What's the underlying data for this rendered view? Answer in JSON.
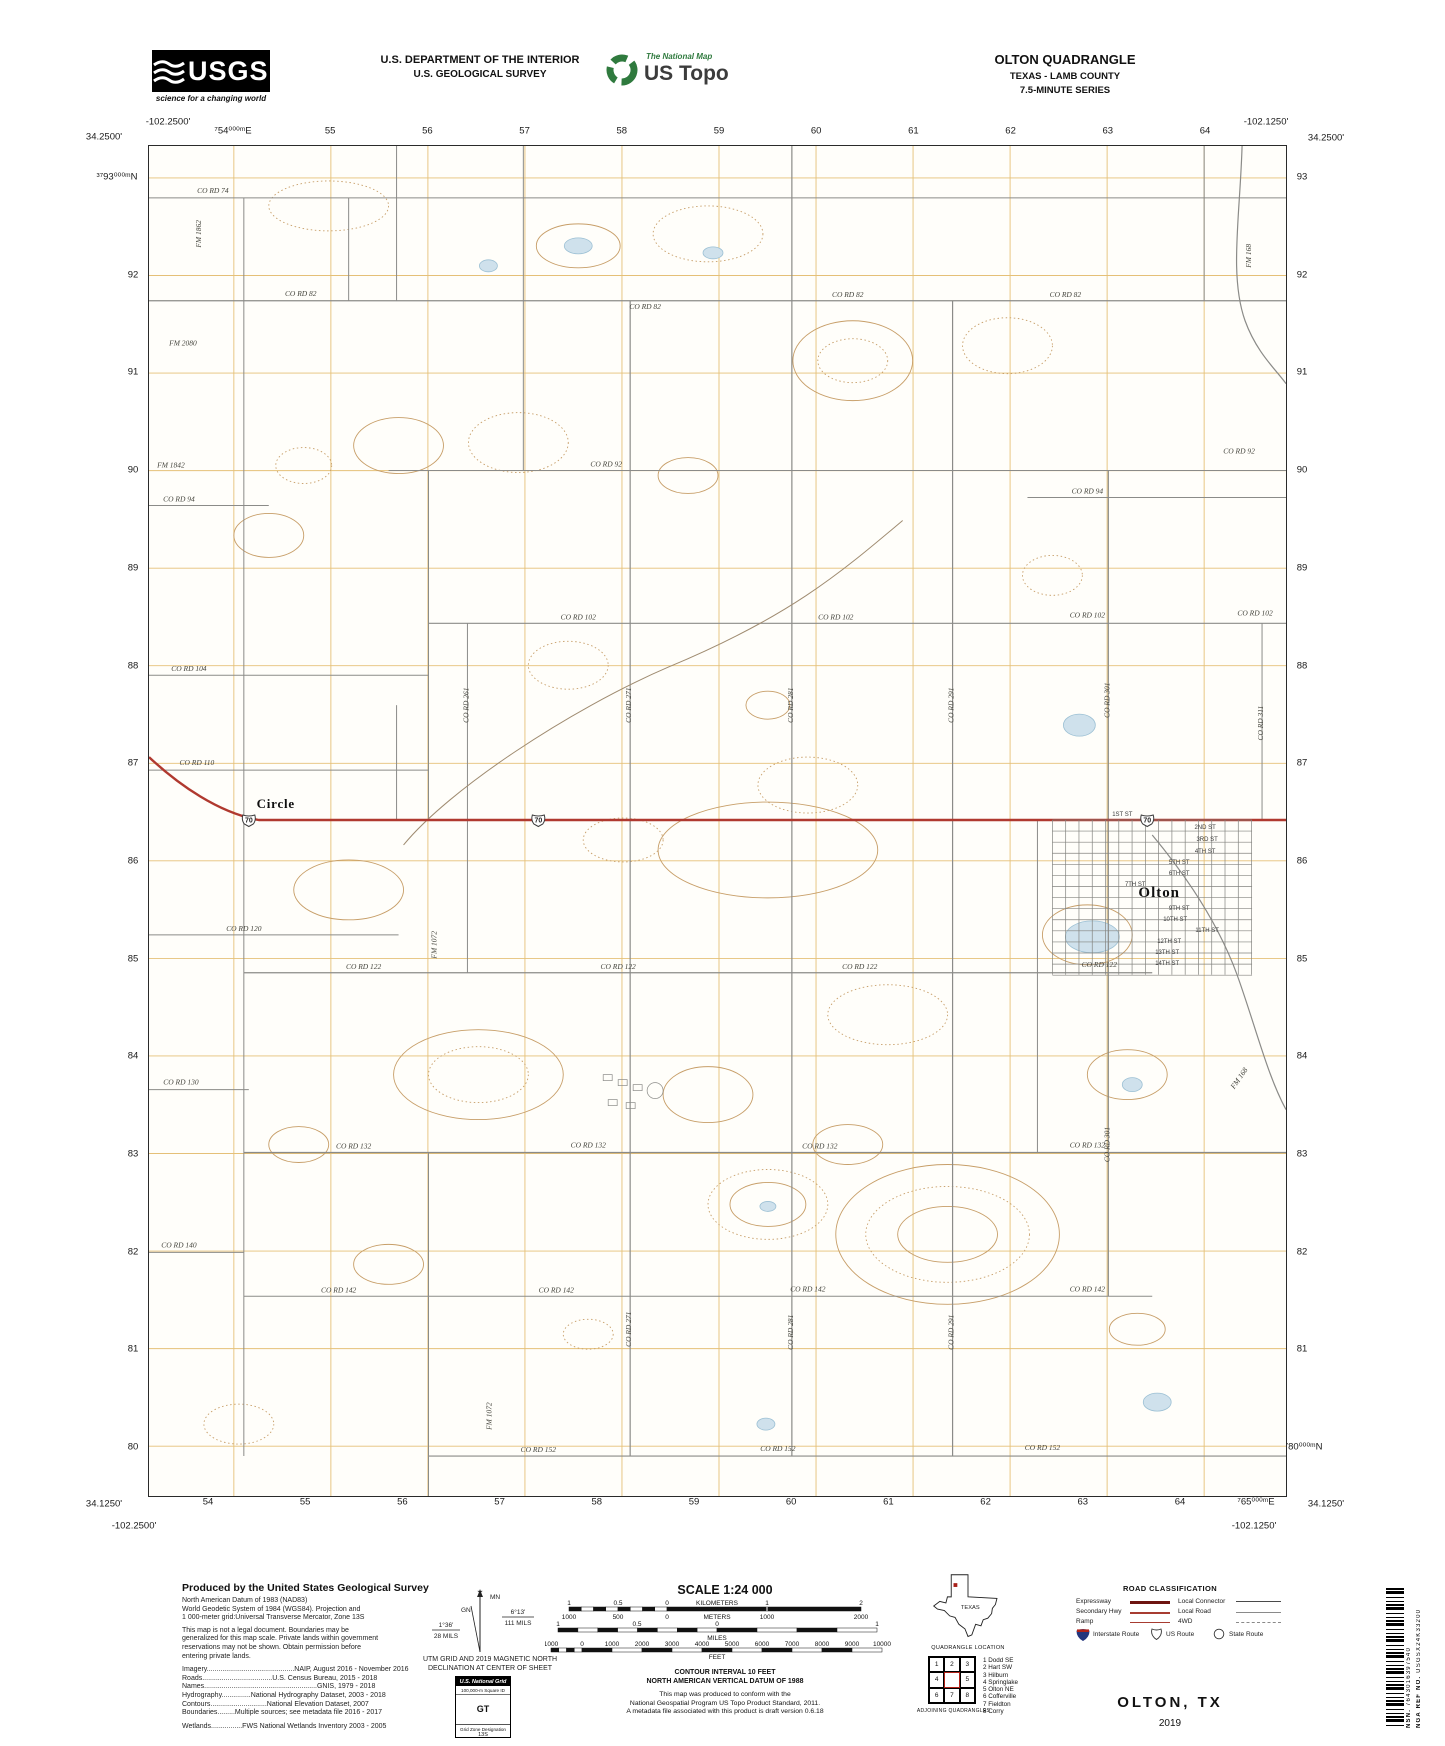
{
  "header": {
    "usgs_acronym": "USGS",
    "usgs_tagline": "science for a changing world",
    "dept_line1": "U.S. DEPARTMENT OF THE INTERIOR",
    "dept_line2": "U.S. GEOLOGICAL SURVEY",
    "brand_top": "The National Map",
    "brand_name": "US Topo",
    "quad_title": "OLTON QUADRANGLE",
    "quad_region": "TEXAS - LAMB COUNTY",
    "quad_series": "7.5-MINUTE SERIES"
  },
  "map": {
    "corners": {
      "tl_lon": "-102.2500'",
      "tl_lat": "34.2500'",
      "tr_lon": "-102.1250'",
      "tr_lat": "34.2500'",
      "bl_lat": "34.1250'",
      "bl_lon": "-102.2500'",
      "br_lon": "-102.1250'",
      "br_lat": "34.1250'"
    },
    "grid": {
      "top_full": "⁷54⁰⁰⁰ᵐE",
      "top": [
        "55",
        "56",
        "57",
        "58",
        "59",
        "60",
        "61",
        "62",
        "63",
        "64"
      ],
      "left_full": "³⁷93⁰⁰⁰ᵐN",
      "left": [
        "92",
        "91",
        "90",
        "89",
        "88",
        "87",
        "86",
        "85",
        "84",
        "83",
        "82",
        "81",
        "80"
      ],
      "right": [
        "93",
        "92",
        "91",
        "90",
        "89",
        "88",
        "87",
        "86",
        "85",
        "84",
        "83",
        "82",
        "81"
      ],
      "right_bottom_full": "³⁷80⁰⁰⁰ᵐN",
      "bottom": [
        "54",
        "55",
        "56",
        "57",
        "58",
        "59",
        "60",
        "61",
        "62",
        "63",
        "64"
      ],
      "bottom_right_full": "⁷65⁰⁰⁰ᵐE"
    },
    "shield_route": "70",
    "labels": [
      {
        "t": "Circle",
        "x": 127,
        "y": 663,
        "c": "place"
      },
      {
        "t": "Olton",
        "x": 1012,
        "y": 752,
        "c": "townname"
      },
      {
        "t": "CO RD 74",
        "x": 64,
        "y": 47,
        "c": "rd"
      },
      {
        "t": "CO RD 82",
        "x": 152,
        "y": 150,
        "c": "rd"
      },
      {
        "t": "CO RD 82",
        "x": 497,
        "y": 163,
        "c": "rd"
      },
      {
        "t": "CO RD 82",
        "x": 700,
        "y": 151,
        "c": "rd"
      },
      {
        "t": "CO RD 82",
        "x": 918,
        "y": 151,
        "c": "rd"
      },
      {
        "t": "FM 2080",
        "x": 34,
        "y": 200,
        "c": "rd"
      },
      {
        "t": "FM 1842",
        "x": 22,
        "y": 322,
        "c": "rd"
      },
      {
        "t": "CO RD 92",
        "x": 458,
        "y": 321,
        "c": "rd"
      },
      {
        "t": "CO RD 92",
        "x": 1092,
        "y": 308,
        "c": "rd"
      },
      {
        "t": "CO RD 94",
        "x": 30,
        "y": 356,
        "c": "rd"
      },
      {
        "t": "CO RD 94",
        "x": 940,
        "y": 348,
        "c": "rd"
      },
      {
        "t": "CO RD 102",
        "x": 430,
        "y": 474,
        "c": "rd"
      },
      {
        "t": "CO RD 102",
        "x": 688,
        "y": 474,
        "c": "rd"
      },
      {
        "t": "CO RD 102",
        "x": 940,
        "y": 472,
        "c": "rd"
      },
      {
        "t": "CO RD 102",
        "x": 1108,
        "y": 470,
        "c": "rd"
      },
      {
        "t": "CO RD 104",
        "x": 40,
        "y": 526,
        "c": "rd"
      },
      {
        "t": "CO RD 110",
        "x": 48,
        "y": 620,
        "c": "rd"
      },
      {
        "t": "CO RD 120",
        "x": 95,
        "y": 786,
        "c": "rd"
      },
      {
        "t": "CO RD 122",
        "x": 215,
        "y": 824,
        "c": "rd"
      },
      {
        "t": "CO RD 122",
        "x": 470,
        "y": 824,
        "c": "rd"
      },
      {
        "t": "CO RD 122",
        "x": 712,
        "y": 824,
        "c": "rd"
      },
      {
        "t": "CO RD 122",
        "x": 952,
        "y": 822,
        "c": "rd"
      },
      {
        "t": "CO RD 130",
        "x": 32,
        "y": 940,
        "c": "rd"
      },
      {
        "t": "CO RD 132",
        "x": 205,
        "y": 1004,
        "c": "rd"
      },
      {
        "t": "CO RD 132",
        "x": 440,
        "y": 1003,
        "c": "rd"
      },
      {
        "t": "CO RD 132",
        "x": 672,
        "y": 1004,
        "c": "rd"
      },
      {
        "t": "CO RD 132",
        "x": 940,
        "y": 1003,
        "c": "rd"
      },
      {
        "t": "CO RD 140",
        "x": 30,
        "y": 1103,
        "c": "rd"
      },
      {
        "t": "CO RD 142",
        "x": 190,
        "y": 1148,
        "c": "rd"
      },
      {
        "t": "CO RD 142",
        "x": 408,
        "y": 1148,
        "c": "rd"
      },
      {
        "t": "CO RD 142",
        "x": 660,
        "y": 1147,
        "c": "rd"
      },
      {
        "t": "CO RD 142",
        "x": 940,
        "y": 1147,
        "c": "rd"
      },
      {
        "t": "CO RD 152",
        "x": 390,
        "y": 1308,
        "c": "rd"
      },
      {
        "t": "CO RD 152",
        "x": 630,
        "y": 1307,
        "c": "rd"
      },
      {
        "t": "CO RD 152",
        "x": 895,
        "y": 1306,
        "c": "rd"
      },
      {
        "t": "FM 1862",
        "x": 52,
        "y": 88,
        "c": "rdv",
        "r": -90
      },
      {
        "t": "CO RD 261",
        "x": 320,
        "y": 560,
        "c": "rdv",
        "r": -90
      },
      {
        "t": "CO RD 271",
        "x": 483,
        "y": 560,
        "c": "rdv",
        "r": -90
      },
      {
        "t": "CO RD 271",
        "x": 483,
        "y": 1185,
        "c": "rdv",
        "r": -90
      },
      {
        "t": "CO RD 281",
        "x": 645,
        "y": 560,
        "c": "rdv",
        "r": -90
      },
      {
        "t": "CO RD 281",
        "x": 645,
        "y": 1188,
        "c": "rdv",
        "r": -90
      },
      {
        "t": "CO RD 291",
        "x": 806,
        "y": 560,
        "c": "rdv",
        "r": -90
      },
      {
        "t": "CO RD 291",
        "x": 806,
        "y": 1188,
        "c": "rdv",
        "r": -90
      },
      {
        "t": "CO RD 301",
        "x": 962,
        "y": 555,
        "c": "rdv",
        "r": -90
      },
      {
        "t": "CO RD 301",
        "x": 962,
        "y": 1000,
        "c": "rdv",
        "r": -90
      },
      {
        "t": "CO RD 311",
        "x": 1116,
        "y": 578,
        "c": "rdv",
        "r": -90
      },
      {
        "t": "FM 168",
        "x": 1104,
        "y": 110,
        "c": "rdv",
        "r": -90
      },
      {
        "t": "FM 168",
        "x": 1094,
        "y": 935,
        "c": "rdv",
        "r": -55
      },
      {
        "t": "FM 1072",
        "x": 288,
        "y": 800,
        "c": "rdv",
        "r": -90
      },
      {
        "t": "FM 1072",
        "x": 343,
        "y": 1272,
        "c": "rdv",
        "r": -90
      },
      {
        "t": "1ST ST",
        "x": 975,
        "y": 671,
        "c": "st"
      },
      {
        "t": "2ND ST",
        "x": 1058,
        "y": 684,
        "c": "st"
      },
      {
        "t": "3RD ST",
        "x": 1060,
        "y": 696,
        "c": "st"
      },
      {
        "t": "4TH ST",
        "x": 1058,
        "y": 708,
        "c": "st"
      },
      {
        "t": "5TH ST",
        "x": 1032,
        "y": 719,
        "c": "st"
      },
      {
        "t": "6TH ST",
        "x": 1032,
        "y": 730,
        "c": "st"
      },
      {
        "t": "7TH ST",
        "x": 988,
        "y": 741,
        "c": "st"
      },
      {
        "t": "9TH ST",
        "x": 1032,
        "y": 765,
        "c": "st"
      },
      {
        "t": "10TH ST",
        "x": 1028,
        "y": 776,
        "c": "st"
      },
      {
        "t": "11TH ST",
        "x": 1060,
        "y": 787,
        "c": "st"
      },
      {
        "t": "12TH ST",
        "x": 1022,
        "y": 798,
        "c": "st"
      },
      {
        "t": "13TH ST",
        "x": 1020,
        "y": 809,
        "c": "st"
      },
      {
        "t": "14TH ST",
        "x": 1020,
        "y": 820,
        "c": "st"
      }
    ]
  },
  "footer": {
    "credits": {
      "title": "Produced by the United States Geological Survey",
      "lines": [
        "North American Datum of 1983 (NAD83)",
        "World Geodetic System of 1984 (WGS84).  Projection and",
        "1 000-meter grid:Universal Transverse Mercator, Zone 13S",
        "This map is not a legal document. Boundaries may be",
        "generalized for this map scale. Private lands within government",
        "reservations may not be shown. Obtain permission before",
        "entering private lands."
      ],
      "sources": [
        "Imagery.............................................NAIP, August 2016 - November 2016",
        "Roads....................................U.S. Census Bureau, 2015 - 2018",
        "Names..........................................................GNIS, 1979 - 2018",
        "Hydrography...............National Hydrography Dataset, 2003 - 2018",
        "Contours.............................National Elevation Dataset, 2007",
        "Boundaries.........Multiple sources; see metadata file 2016 - 2017",
        "Wetlands................FWS National Wetlands Inventory 2003 - 2005"
      ]
    },
    "declination": {
      "mn_label": "MN",
      "gn_label": "GN",
      "star": "★",
      "mn_deg": "6°13'",
      "mn_mils": "111 MILS",
      "gn_deg": "1°36'",
      "gn_mils": "28 MILS",
      "caption1": "UTM GRID AND 2019 MAGNETIC NORTH",
      "caption2": "DECLINATION AT CENTER OF SHEET"
    },
    "usng": {
      "title": "U.S. National Grid",
      "sub": "100,000-m Square ID",
      "square": "GT",
      "zone_label": "Grid Zone Designation",
      "zone": "13S"
    },
    "scale": {
      "title": "SCALE 1:24 000",
      "km_ticks": [
        "1",
        "0.5",
        "0",
        "1",
        "2"
      ],
      "km_unit": "KILOMETERS",
      "m_ticks": [
        "1000",
        "500",
        "0",
        "1000",
        "2000"
      ],
      "m_unit": "METERS",
      "mi_ticks": [
        "1",
        "0.5",
        "0",
        "1"
      ],
      "mi_unit": "MILES",
      "ft_ticks": [
        "1000",
        "0",
        "1000",
        "2000",
        "3000",
        "4000",
        "5000",
        "6000",
        "7000",
        "8000",
        "9000",
        "10000"
      ],
      "ft_unit": "FEET",
      "contour": "CONTOUR INTERVAL 10 FEET",
      "datum": "NORTH AMERICAN VERTICAL DATUM OF 1988",
      "conform1": "This map was produced to conform with the",
      "conform2": "National Geospatial Program US Topo Product Standard, 2011.",
      "conform3": "A metadata file associated with this product is draft version 0.6.18"
    },
    "location": {
      "state": "TEXAS",
      "caption": "QUADRANGLE LOCATION"
    },
    "adjoining": {
      "caption": "ADJOINING QUADRANGLES",
      "cells": [
        "1",
        "2",
        "3",
        "4",
        "",
        "5",
        "6",
        "7",
        "8"
      ],
      "list": [
        "1 Dodd SE",
        "2 Hart SW",
        "3 Hilburn",
        "4 Springlake",
        "5 Olton NE",
        "6 Cofferville",
        "7 Fieldton",
        "8 Corry"
      ]
    },
    "roadclass": {
      "title": "ROAD CLASSIFICATION",
      "rows_left": [
        "Expressway",
        "Secondary Hwy",
        "Ramp"
      ],
      "rows_right": [
        "Local Connector",
        "Local Road",
        "4WD"
      ],
      "shields": [
        "Interstate Route",
        "US Route",
        "State Route"
      ]
    },
    "sheet": {
      "name": "OLTON, TX",
      "year": "2019"
    },
    "barcode": {
      "nsn_label": "NSN.",
      "nsn": "7643016397540",
      "nga_label": "NGA REF NO.",
      "nga": "USGSX24K33200"
    }
  }
}
